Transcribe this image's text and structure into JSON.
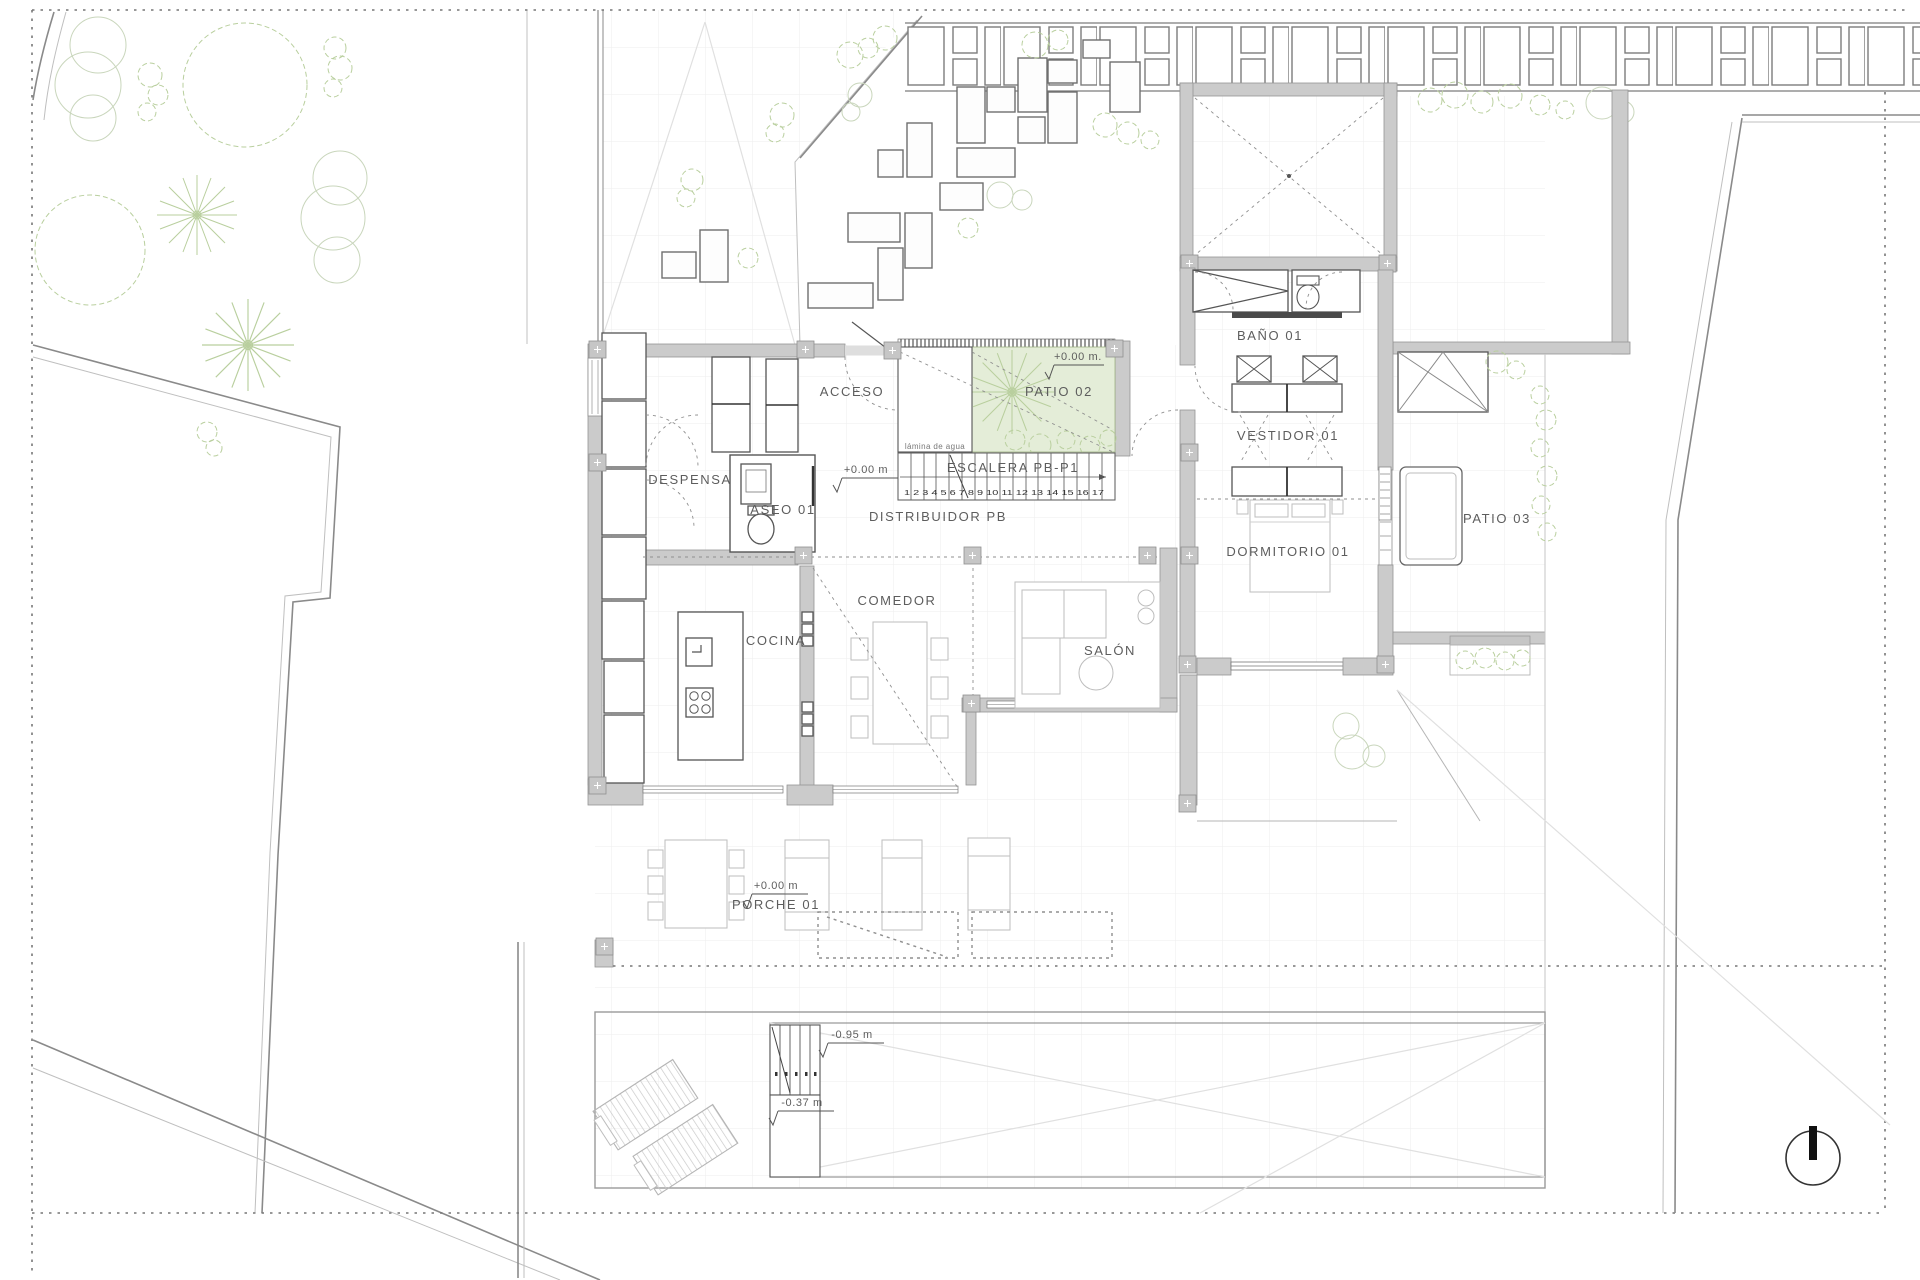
{
  "drawing": {
    "kind": "ground-floor-plan",
    "colors": {
      "wall_fill": "#cbcbcb",
      "wall_stroke": "#949494",
      "patio_green": "#e4edd8",
      "plant_green": "#b9cf9e",
      "label_gray": "#5d5d5d"
    },
    "rooms": {
      "acceso": "ACCESO",
      "patio02": "PATIO 02",
      "despensa": "DESPENSA",
      "aseo01": "ASEO 01",
      "escalera": "ESCALERA PB-P1",
      "distribuidor": "DISTRIBUIDOR PB",
      "cocina": "COCINA",
      "comedor": "COMEDOR",
      "salon": "SALÓN",
      "bano01": "BAÑO 01",
      "vestidor01": "VESTIDOR 01",
      "dormitorio01": "DORMITORIO 01",
      "patio03": "PATIO 03",
      "porche01": "PORCHE 01"
    },
    "levels": {
      "ground_dot": "+0.00 m.",
      "ground": "+0.00 m",
      "pool_step": "-0.95 m",
      "pool_bench": "-0.37 m"
    },
    "annotations": {
      "water_feature": "lámina de agua",
      "stair_treads": "1 2 3 4 5 6 7 8 9 10 11 12 13 14 15 16 17"
    },
    "icons": {
      "north_arrow": "north-arrow"
    }
  }
}
